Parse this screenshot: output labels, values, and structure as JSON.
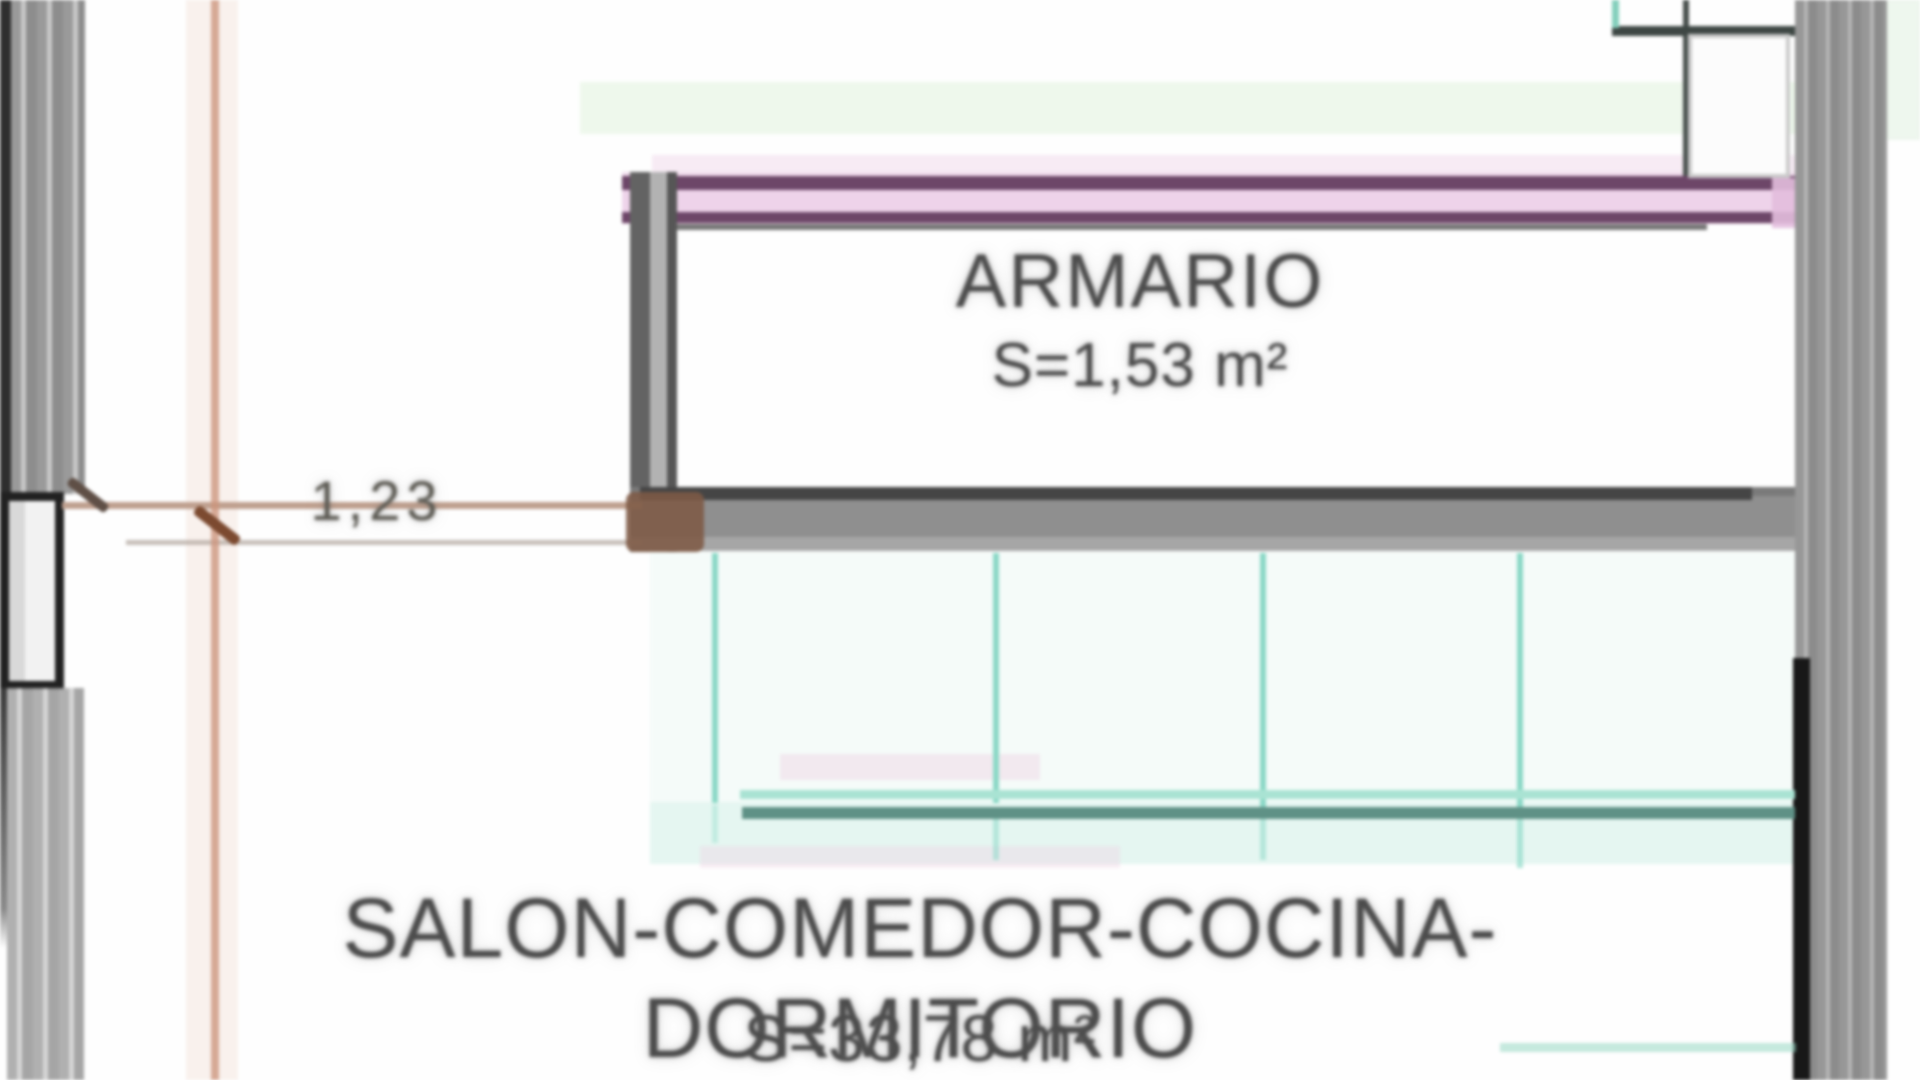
{
  "plan": {
    "type": "floor-plan",
    "rooms": [
      {
        "name": "ARMARIO",
        "area": "S=1,53 m²"
      },
      {
        "name": "SALON-COMEDOR-COCINA-DORMITORIO",
        "area": "S=33,78 m²"
      }
    ],
    "dimensions": [
      {
        "label": "1,23"
      }
    ],
    "colors": {
      "wall_gray": "#8e8e8e",
      "wall_dark": "#2e2e2e",
      "partition_pink_fill": "#eed3ea",
      "partition_pink_line": "#6d4668",
      "glazing_teal": "#8bd8c6",
      "glazing_teal_dark": "#5f9186",
      "dimension_tan": "#cc957c",
      "dimension_tick_brown": "#7c4a30",
      "text_ink": "#4c4c4c"
    }
  }
}
